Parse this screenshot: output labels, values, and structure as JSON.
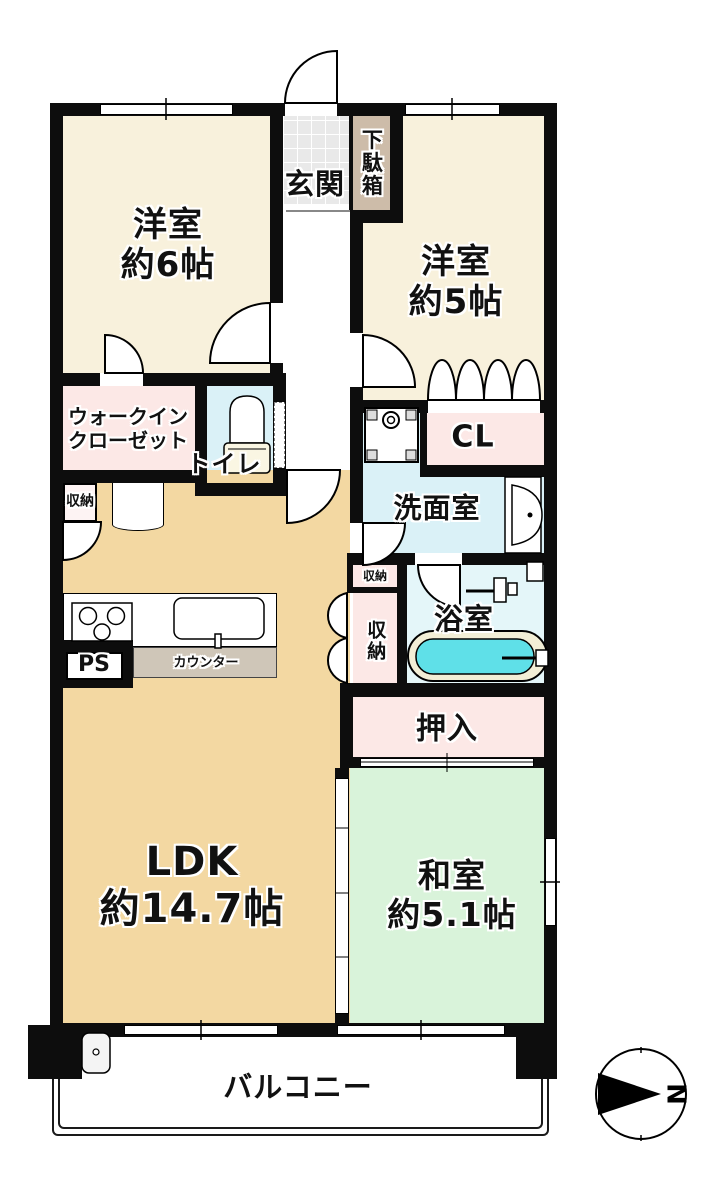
{
  "rooms": {
    "genkan": "玄関",
    "getabako": "下駄箱",
    "western6": "洋室\n約6帖",
    "western5": "洋室\n約5帖",
    "wic": "ウォークイン\nクローゼット",
    "toilet": "トイレ",
    "closet_cl": "CL",
    "washroom": "洗面室",
    "storage_left": "収納",
    "storage_mid": "収納",
    "storage_tall": "収納",
    "bathroom": "浴室",
    "oshiire": "押入",
    "ldk": "LDK\n約14.7帖",
    "japanese_room": "和室\n約5.1帖",
    "balcony": "バルコニー",
    "pipe_space": "PS",
    "counter": "カウンター"
  },
  "compass": {
    "north_label": "N"
  },
  "colors": {
    "wall": "#0d0d0d",
    "western_room": "#f8f1dc",
    "ldk": "#f3d8a2",
    "japanese_room": "#d9f3da",
    "closet_pink": "#fce8e6",
    "wet_blue": "#daf1f7",
    "bath_blue": "#e4f6f9",
    "bath_water": "#5fe0e8",
    "tub_rim": "#f2eed6",
    "entrance_tile": "#e9e9e9",
    "shoe_cabinet": "#cdbca9",
    "counter_top": "#cfc6b8"
  }
}
